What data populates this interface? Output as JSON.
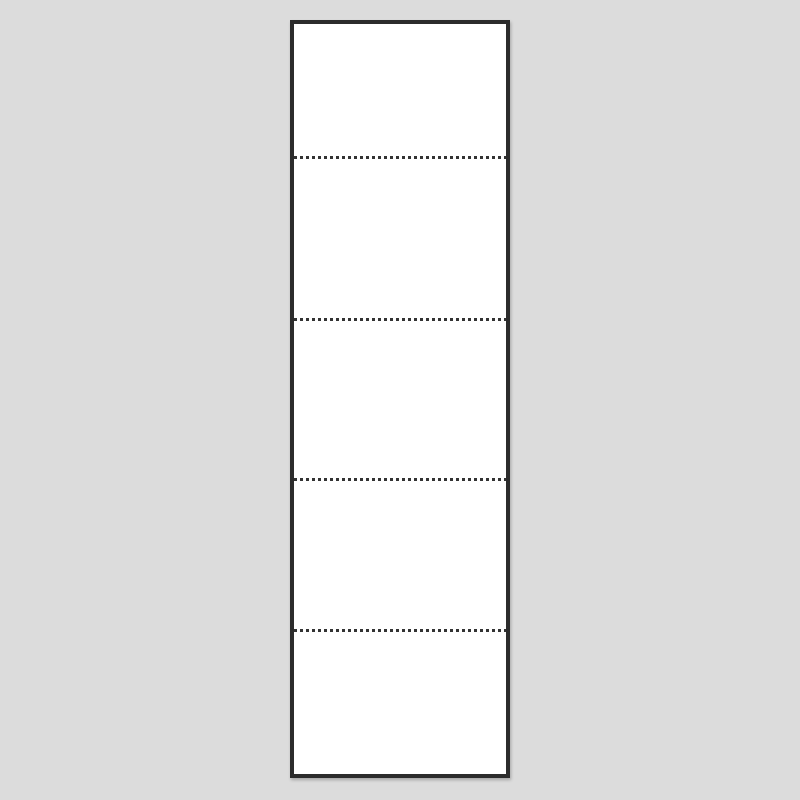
{
  "scene": {
    "colors": {
      "background": "#dcdcdc",
      "sheet_fill": "#ffffff",
      "sheet_border": "#2c2c2c",
      "perforation": "#333333"
    },
    "sheet": {
      "left": 290,
      "top": 20,
      "width": 220,
      "height": 758,
      "border_width": 4,
      "panel_count": 5
    },
    "perforation": {
      "line_y_centers": [
        157,
        319,
        479,
        630
      ],
      "thickness": 3,
      "dot_length": 3,
      "gap_length": 3
    }
  }
}
